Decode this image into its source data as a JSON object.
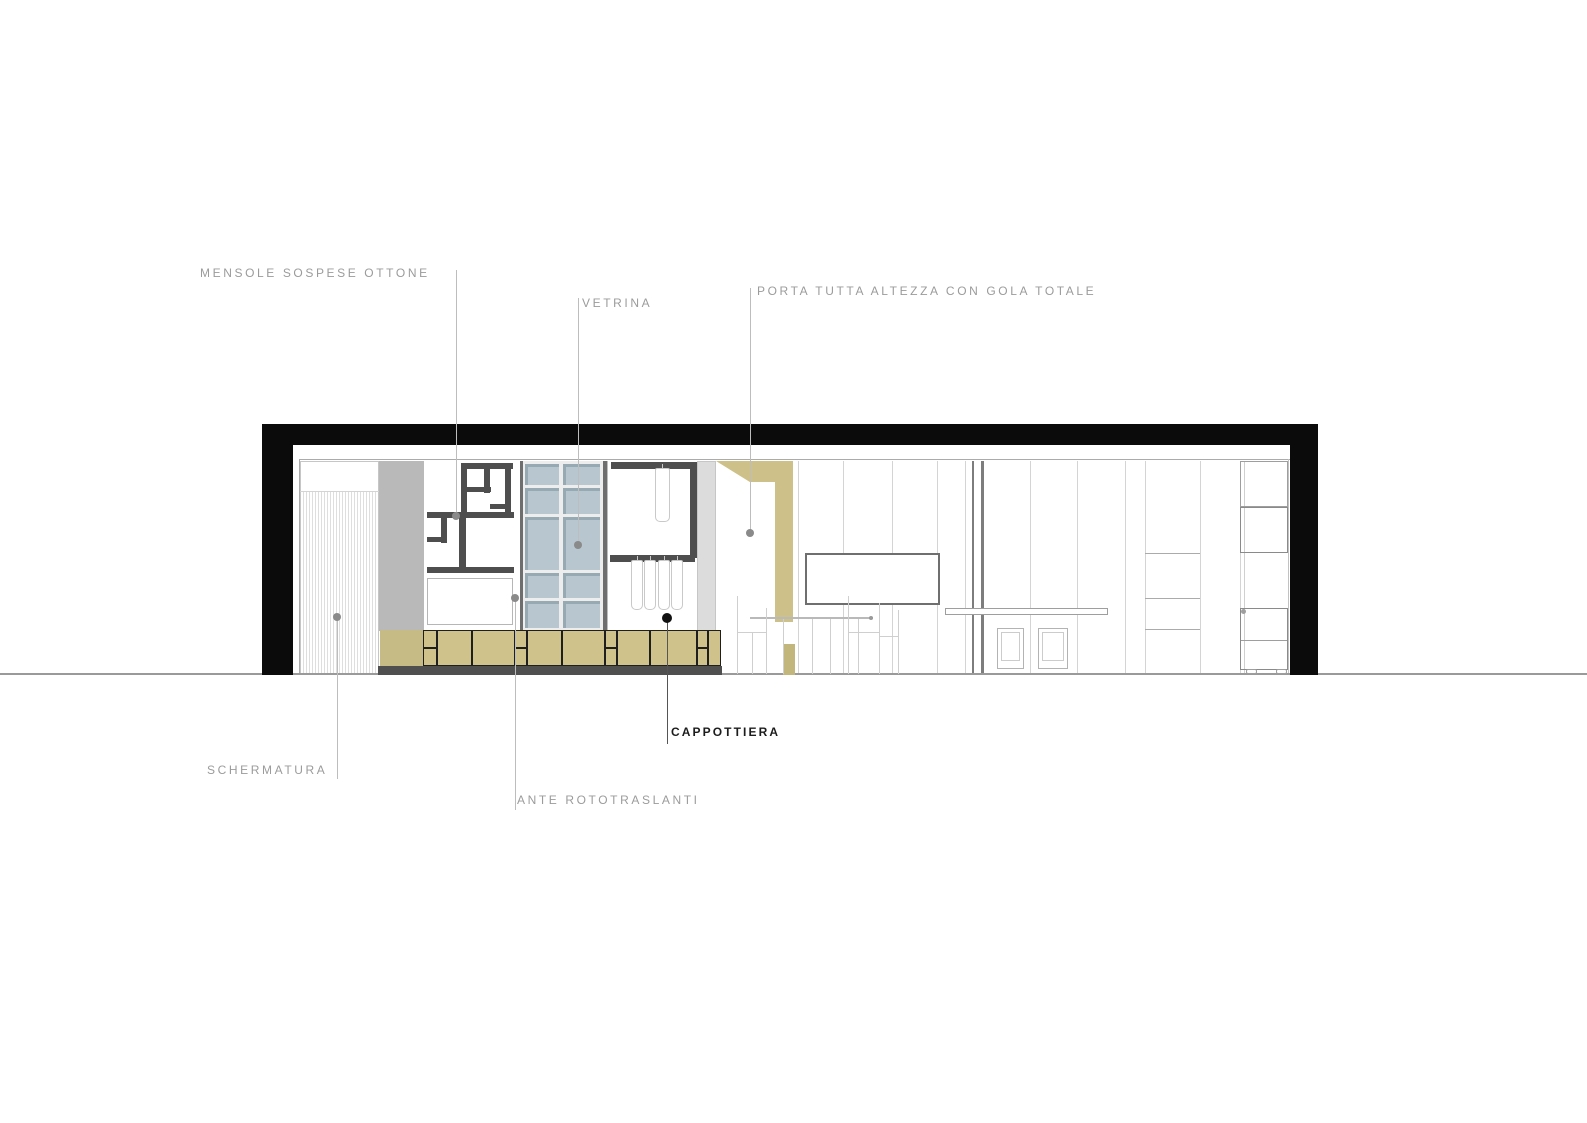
{
  "drawing_title": "interior-section-elevation",
  "colors": {
    "label_gray": "#9b9b9b",
    "label_dark": "#1c1c1c",
    "wall_black": "#0b0b0b",
    "khaki": "#cdc089",
    "khaki_dark": "#c3b67d",
    "khaki_plain": "#c6ba85",
    "glass_blue": "#b7c6cf",
    "glass_edge": "#97aab4",
    "bar_gray": "#4e4e4e",
    "panel_gray": "#b9b9b9",
    "panel_light": "#dcdcdc",
    "plinth_gray": "#4f4f4f",
    "leader_gray": "#bdbdbd",
    "dot_gray": "#8a8a8a"
  },
  "labels": [
    {
      "id": "mensole",
      "text": "MENSOLE SOSPESE OTTONE"
    },
    {
      "id": "vetrina",
      "text": "VETRINA"
    },
    {
      "id": "porta",
      "text": "PORTA TUTTA ALTEZZA CON GOLA TOTALE"
    },
    {
      "id": "schermatura",
      "text": "SCHERMATURA"
    },
    {
      "id": "ante",
      "text": "ANTE ROTOTRASLANTI"
    },
    {
      "id": "cappottiera",
      "text": "CAPPOTTIERA"
    }
  ],
  "figure": {
    "shapes": [
      {
        "n": "floor-line",
        "x": 0,
        "y": 673,
        "w": 1587,
        "h": 2,
        "bg": "#9a9a9a",
        "z": 4
      },
      {
        "n": "wall-top-band",
        "x": 262,
        "y": 424,
        "w": 1056,
        "h": 21,
        "bg": "#0b0b0b",
        "z": 10
      },
      {
        "n": "wall-left",
        "x": 262,
        "y": 424,
        "w": 31,
        "h": 251,
        "bg": "#0b0b0b",
        "z": 10
      },
      {
        "n": "wall-right",
        "x": 1290,
        "y": 424,
        "w": 28,
        "h": 251,
        "bg": "#0b0b0b",
        "z": 10
      },
      {
        "n": "ceiling-line",
        "x": 300,
        "y": 459,
        "w": 990,
        "h": 1,
        "bg": "#ababab",
        "z": 2
      },
      {
        "n": "interior-left-line",
        "x": 299,
        "y": 459,
        "w": 1,
        "h": 216,
        "bg": "#ababab",
        "z": 2
      },
      {
        "n": "interior-right-line",
        "x": 1288,
        "y": 459,
        "w": 1,
        "h": 216,
        "bg": "#c2c2c2",
        "z": 2
      },
      {
        "n": "screen-panel",
        "x": 300,
        "y": 461,
        "w": 79,
        "h": 214,
        "bg": "#ffffff",
        "b": "1px solid #c6c6c6",
        "z": 1
      },
      {
        "n": "screen-top-divider",
        "x": 300,
        "y": 491,
        "w": 79,
        "h": 1,
        "bg": "#d4d4d4",
        "z": 3
      },
      {
        "n": "tall-side-panel",
        "x": 379,
        "y": 461,
        "w": 45,
        "h": 170,
        "bg": "#b9b9b9",
        "z": 3
      },
      {
        "n": "shelf-bar",
        "x": 461,
        "y": 463,
        "w": 52,
        "h": 6,
        "bg": "#4e4e4e",
        "z": 5
      },
      {
        "n": "shelf-bar",
        "x": 461,
        "y": 463,
        "w": 6,
        "h": 54,
        "bg": "#4e4e4e",
        "z": 5
      },
      {
        "n": "shelf-bar",
        "x": 484,
        "y": 468,
        "w": 6,
        "h": 25,
        "bg": "#4e4e4e",
        "z": 5
      },
      {
        "n": "shelf-bar",
        "x": 467,
        "y": 487,
        "w": 24,
        "h": 5,
        "bg": "#4e4e4e",
        "z": 5
      },
      {
        "n": "shelf-bar",
        "x": 505,
        "y": 463,
        "w": 6,
        "h": 53,
        "bg": "#4e4e4e",
        "z": 5
      },
      {
        "n": "shelf-bar",
        "x": 490,
        "y": 504,
        "w": 21,
        "h": 5,
        "bg": "#4e4e4e",
        "z": 5
      },
      {
        "n": "shelf-bar",
        "x": 427,
        "y": 512,
        "w": 87,
        "h": 6,
        "bg": "#4e4e4e",
        "z": 5
      },
      {
        "n": "shelf-bar",
        "x": 441,
        "y": 518,
        "w": 6,
        "h": 25,
        "bg": "#4e4e4e",
        "z": 5
      },
      {
        "n": "shelf-bar",
        "x": 427,
        "y": 537,
        "w": 20,
        "h": 5,
        "bg": "#4e4e4e",
        "z": 5
      },
      {
        "n": "shelf-bar",
        "x": 459,
        "y": 518,
        "w": 7,
        "h": 55,
        "bg": "#4e4e4e",
        "z": 5
      },
      {
        "n": "shelf-bar",
        "x": 427,
        "y": 567,
        "w": 87,
        "h": 6,
        "bg": "#4e4e4e",
        "z": 5
      },
      {
        "n": "mensole-lower-panel",
        "x": 427,
        "y": 578,
        "w": 86,
        "h": 47,
        "bg": "#ffffff",
        "b": "1px solid #b6b6b6",
        "z": 5
      },
      {
        "n": "vetrina-frame-bg",
        "x": 520,
        "y": 461,
        "w": 87,
        "h": 170,
        "bg": "#ededed",
        "z": 3
      },
      {
        "n": "vetrina-edge-left",
        "x": 520,
        "y": 461,
        "w": 3,
        "h": 170,
        "bg": "#6e6e6e",
        "z": 5
      },
      {
        "n": "vetrina-edge-right",
        "x": 603,
        "y": 461,
        "w": 4,
        "h": 170,
        "bg": "#6e6e6e",
        "z": 5
      },
      {
        "n": "wardrobe-left-line",
        "x": 607,
        "y": 461,
        "w": 1,
        "h": 170,
        "bg": "#bdbdbd",
        "z": 3
      },
      {
        "n": "wardrobe-top-rail",
        "x": 611,
        "y": 462,
        "w": 81,
        "h": 7,
        "bg": "#4e4e4e",
        "z": 5
      },
      {
        "n": "wardrobe-right-post",
        "x": 690,
        "y": 462,
        "w": 7,
        "h": 96,
        "bg": "#4e4e4e",
        "z": 5
      },
      {
        "n": "wardrobe-mid-rail",
        "x": 610,
        "y": 555,
        "w": 85,
        "h": 7,
        "bg": "#4e4e4e",
        "z": 5
      },
      {
        "n": "wardrobe-side-panel",
        "x": 697,
        "y": 461,
        "w": 19,
        "h": 170,
        "bg": "#dcdcdc",
        "b": "1px solid #c6c6c6",
        "z": 3
      },
      {
        "n": "door-head-band",
        "x": 716,
        "y": 461,
        "w": 77,
        "h": 21,
        "bg": "#cdc089",
        "clip": "polygon(0 0,100% 0,100% 100%,44% 100%)",
        "z": 6
      },
      {
        "n": "door-jamb",
        "x": 775,
        "y": 482,
        "w": 18,
        "h": 140,
        "bg": "#cdc089",
        "z": 6
      },
      {
        "n": "door-jamb-lower",
        "x": 783,
        "y": 644,
        "w": 12,
        "h": 31,
        "bg": "#c3b67d",
        "z": 6
      },
      {
        "n": "partition-line-a",
        "x": 972,
        "y": 461,
        "w": 2,
        "h": 214,
        "bg": "#7d7d7d",
        "z": 3
      },
      {
        "n": "partition-line-b",
        "x": 981,
        "y": 461,
        "w": 3,
        "h": 214,
        "bg": "#7d7d7d",
        "z": 3
      },
      {
        "n": "wall-niche-panel",
        "x": 805,
        "y": 553,
        "w": 135,
        "h": 52,
        "bg": "#ffffff",
        "b": "2px solid #6f6f6f",
        "z": 7
      },
      {
        "n": "table-top",
        "x": 750,
        "y": 617,
        "w": 123,
        "h": 2,
        "bg": "#b9b9b9",
        "z": 8
      },
      {
        "n": "table-end-dot",
        "x": 869,
        "y": 616,
        "w": 4,
        "h": 4,
        "bg": "#9a9a9a",
        "r": "50%",
        "z": 8
      },
      {
        "n": "table-leg",
        "x": 783,
        "y": 619,
        "w": 1,
        "h": 55,
        "bg": "#cfcfcf",
        "z": 8
      },
      {
        "n": "table-leg",
        "x": 812,
        "y": 619,
        "w": 1,
        "h": 55,
        "bg": "#cfcfcf",
        "z": 8
      },
      {
        "n": "table-leg",
        "x": 830,
        "y": 619,
        "w": 1,
        "h": 55,
        "bg": "#cfcfcf",
        "z": 8
      },
      {
        "n": "table-leg",
        "x": 858,
        "y": 619,
        "w": 1,
        "h": 55,
        "bg": "#cfcfcf",
        "z": 8
      },
      {
        "n": "chair-back",
        "x": 737,
        "y": 596,
        "w": 1,
        "h": 78,
        "bg": "#cfcfcf",
        "z": 8
      },
      {
        "n": "chair-back",
        "x": 766,
        "y": 608,
        "w": 1,
        "h": 66,
        "bg": "#cfcfcf",
        "z": 8
      },
      {
        "n": "chair-seat",
        "x": 737,
        "y": 632,
        "w": 30,
        "h": 1,
        "bg": "#cfcfcf",
        "z": 8
      },
      {
        "n": "chair-leg",
        "x": 752,
        "y": 632,
        "w": 1,
        "h": 42,
        "bg": "#cfcfcf",
        "z": 8
      },
      {
        "n": "chair-back",
        "x": 848,
        "y": 596,
        "w": 1,
        "h": 78,
        "bg": "#cfcfcf",
        "z": 8
      },
      {
        "n": "chair-seat",
        "x": 848,
        "y": 632,
        "w": 31,
        "h": 1,
        "bg": "#cfcfcf",
        "z": 8
      },
      {
        "n": "chair-back",
        "x": 879,
        "y": 603,
        "w": 1,
        "h": 71,
        "bg": "#cfcfcf",
        "z": 8
      },
      {
        "n": "chair-back",
        "x": 898,
        "y": 610,
        "w": 1,
        "h": 64,
        "bg": "#cfcfcf",
        "z": 8
      },
      {
        "n": "chair-seat",
        "x": 879,
        "y": 636,
        "w": 20,
        "h": 1,
        "bg": "#cfcfcf",
        "z": 8
      },
      {
        "n": "wall-shelf",
        "x": 945,
        "y": 608,
        "w": 163,
        "h": 7,
        "bg": "#ffffff",
        "b": "1px solid #9e9e9e",
        "z": 9
      },
      {
        "n": "closet-divider",
        "x": 1145,
        "y": 553,
        "w": 55,
        "h": 1,
        "bg": "#ababab",
        "z": 3
      },
      {
        "n": "closet-divider",
        "x": 1145,
        "y": 598,
        "w": 55,
        "h": 1,
        "bg": "#ababab",
        "z": 3
      },
      {
        "n": "closet-divider",
        "x": 1145,
        "y": 629,
        "w": 55,
        "h": 1,
        "bg": "#ababab",
        "z": 3
      },
      {
        "n": "bookcase-edge",
        "x": 1244,
        "y": 461,
        "w": 1,
        "h": 212,
        "bg": "#d0d0d0",
        "z": 3
      },
      {
        "n": "bookcase-box-top",
        "x": 1240,
        "y": 461,
        "w": 48,
        "h": 46,
        "b": "1px solid #9e9e9e",
        "z": 5
      },
      {
        "n": "bookcase-box-mid",
        "x": 1240,
        "y": 507,
        "w": 48,
        "h": 46,
        "b": "1.5px solid #8a8a8a",
        "z": 5
      },
      {
        "n": "bookcase-lower-cabinet",
        "x": 1240,
        "y": 608,
        "w": 48,
        "h": 62,
        "b": "1.5px solid #8a8a8a",
        "z": 5
      },
      {
        "n": "bookcase-lower-divider",
        "x": 1241,
        "y": 640,
        "w": 46,
        "h": 1,
        "bg": "#9e9e9e",
        "z": 5
      },
      {
        "n": "bookcase-hinge-dot",
        "x": 1241,
        "y": 609,
        "w": 5,
        "h": 5,
        "bg": "#9e9e9e",
        "r": "50%",
        "z": 6
      },
      {
        "n": "caster",
        "x": 1246,
        "y": 669,
        "w": 11,
        "h": 5,
        "b": "1px solid #9e9e9e",
        "r": "2px",
        "z": 6
      },
      {
        "n": "caster",
        "x": 1276,
        "y": 669,
        "w": 11,
        "h": 5,
        "b": "1px solid #9e9e9e",
        "r": "2px",
        "z": 6
      },
      {
        "n": "base-cabinet-plain",
        "x": 380,
        "y": 630,
        "w": 43,
        "h": 36,
        "bg": "#c6ba85",
        "z": 19
      },
      {
        "n": "plinth",
        "x": 378,
        "y": 666,
        "w": 344,
        "h": 9,
        "bg": "#4f4f4f",
        "z": 21
      },
      {
        "n": "leader-line-mensole",
        "x": 456,
        "y": 270,
        "w": 1,
        "h": 246,
        "bg": "#bdbdbd",
        "z": 60
      },
      {
        "n": "leader-dot-mensole",
        "x": 452,
        "y": 512,
        "w": 8,
        "h": 8,
        "bg": "#8a8a8a",
        "r": "50%",
        "z": 60
      },
      {
        "n": "leader-line-vetrina",
        "x": 578,
        "y": 298,
        "w": 1,
        "h": 247,
        "bg": "#bdbdbd",
        "z": 60
      },
      {
        "n": "leader-dot-vetrina",
        "x": 574,
        "y": 541,
        "w": 8,
        "h": 8,
        "bg": "#8a8a8a",
        "r": "50%",
        "z": 60
      },
      {
        "n": "leader-line-porta",
        "x": 750,
        "y": 288,
        "w": 1,
        "h": 245,
        "bg": "#bdbdbd",
        "z": 60
      },
      {
        "n": "leader-dot-porta",
        "x": 746,
        "y": 529,
        "w": 8,
        "h": 8,
        "bg": "#8a8a8a",
        "r": "50%",
        "z": 60
      },
      {
        "n": "leader-line-schermatura",
        "x": 337,
        "y": 617,
        "w": 1,
        "h": 162,
        "bg": "#bdbdbd",
        "z": 60
      },
      {
        "n": "leader-dot-schermatura",
        "x": 333,
        "y": 613,
        "w": 8,
        "h": 8,
        "bg": "#8a8a8a",
        "r": "50%",
        "z": 60
      },
      {
        "n": "leader-line-ante",
        "x": 515,
        "y": 598,
        "w": 1,
        "h": 212,
        "bg": "#bdbdbd",
        "z": 60
      },
      {
        "n": "leader-dot-ante",
        "x": 511,
        "y": 594,
        "w": 8,
        "h": 8,
        "bg": "#8a8a8a",
        "r": "50%",
        "z": 60
      },
      {
        "n": "leader-line-cappottiera",
        "x": 667,
        "y": 618,
        "w": 1,
        "h": 126,
        "bg": "#555555",
        "z": 60
      },
      {
        "n": "leader-dot-cappottiera",
        "x": 662,
        "y": 613,
        "w": 10,
        "h": 10,
        "bg": "#111111",
        "r": "50%",
        "z": 60
      }
    ],
    "stripes": {
      "x1": 303,
      "x2": 376,
      "step": 3,
      "y": 492,
      "h": 183,
      "color": "#dedede"
    },
    "glass": {
      "fill": "#b7c6cf",
      "edge": "#97aab4",
      "cols": [
        {
          "x": 525,
          "w": 34
        },
        {
          "x": 563,
          "w": 37
        }
      ],
      "rows": [
        {
          "y": 464,
          "h": 21
        },
        {
          "y": 488,
          "h": 26
        },
        {
          "y": 517,
          "h": 53
        },
        {
          "y": 573,
          "h": 25
        },
        {
          "y": 601,
          "h": 27
        }
      ]
    },
    "garments": {
      "items": [
        {
          "x": 655,
          "y": 468,
          "w": 15,
          "h": 54
        },
        {
          "x": 631,
          "y": 560,
          "w": 12,
          "h": 50
        },
        {
          "x": 644,
          "y": 560,
          "w": 12,
          "h": 50
        },
        {
          "x": 658,
          "y": 560,
          "w": 12,
          "h": 50
        },
        {
          "x": 671,
          "y": 560,
          "w": 12,
          "h": 50
        }
      ]
    },
    "cabinet": {
      "y": 630,
      "h": 36,
      "fill": "#cfc28b",
      "line": "#1f1f1f",
      "modules": [
        {
          "x": 423,
          "w": 14,
          "split": true
        },
        {
          "x": 437,
          "w": 35
        },
        {
          "x": 472,
          "w": 43
        },
        {
          "x": 515,
          "w": 12,
          "split": true
        },
        {
          "x": 527,
          "w": 35
        },
        {
          "x": 562,
          "w": 43
        },
        {
          "x": 605,
          "w": 12,
          "split": true
        },
        {
          "x": 617,
          "w": 33
        },
        {
          "x": 650,
          "w": 47
        },
        {
          "x": 697,
          "w": 11,
          "split": true
        },
        {
          "x": 708,
          "w": 13
        }
      ]
    },
    "wall_lines": {
      "xs": [
        798,
        843,
        892,
        937,
        965,
        1030,
        1077,
        1125,
        1145,
        1200,
        1240
      ],
      "y": 461,
      "h": 213,
      "color": "#d4d4d4"
    },
    "framed_panels": {
      "y": 628,
      "h": 41,
      "items": [
        {
          "x": 997,
          "w": 27
        },
        {
          "x": 1038,
          "w": 30
        }
      ]
    }
  }
}
